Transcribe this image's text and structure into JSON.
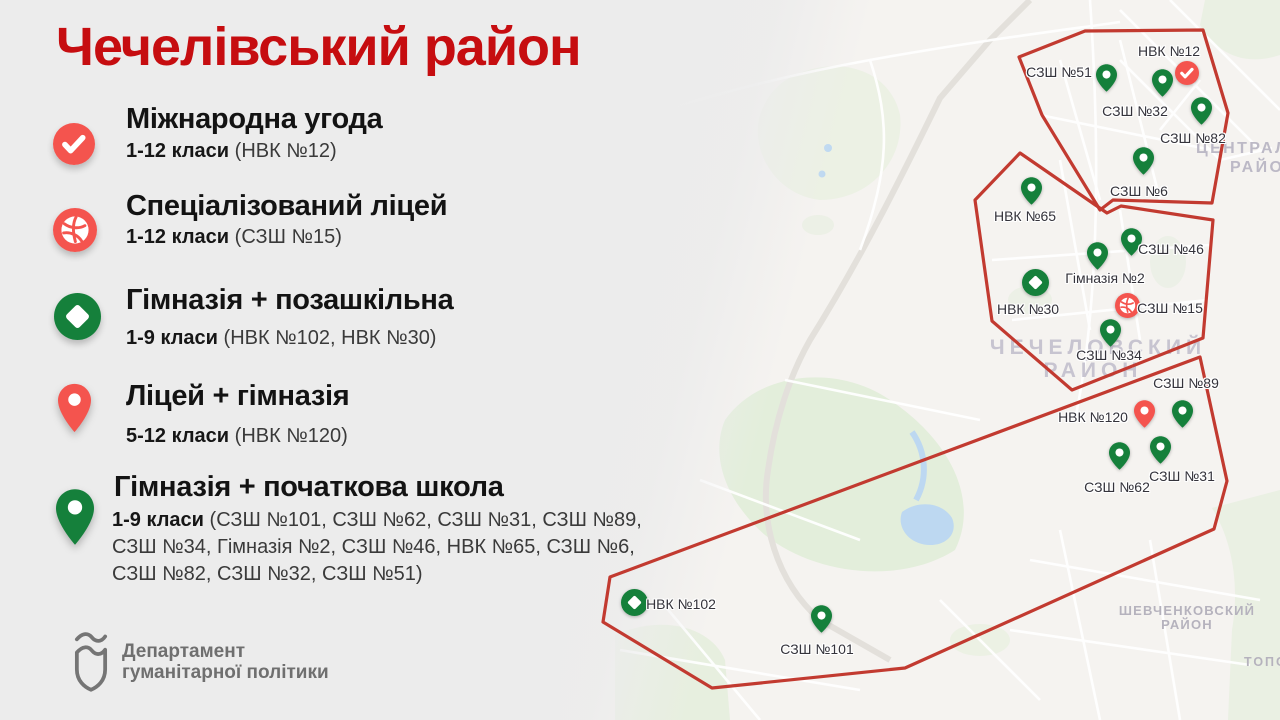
{
  "page": {
    "title": "Чечелівський район"
  },
  "colors": {
    "title_red": "#c60d10",
    "marker_red": "#f4544e",
    "marker_green": "#15803b",
    "region_outline_red": "#c23a30",
    "background_gray": "#ececec",
    "logo_gray": "#6f6f6f"
  },
  "legend": {
    "items": [
      {
        "icon": "check-circle",
        "title": "Міжнародна угода",
        "grades": "1-12 класи",
        "schools": "(НВК №12)"
      },
      {
        "icon": "ball-circle",
        "title": "Спеціалізований ліцей",
        "grades": "1-12 класи",
        "schools": "(СЗШ №15)"
      },
      {
        "icon": "diamond-circle",
        "title": "Гімназія + позашкільна",
        "grades": "1-9 класи",
        "schools": "(НВК №102, НВК №30)"
      },
      {
        "icon": "red-pin",
        "title": "Ліцей + гімназія",
        "grades": "5-12 класи",
        "schools": "(НВК №120)"
      },
      {
        "icon": "green-pin",
        "title": "Гімназія + початкова школа",
        "grades": "1-9 класи",
        "schools": "(СЗШ №101, СЗШ №62, СЗШ №31, СЗШ №89, СЗШ №34, Гімназія №2, СЗШ №46, НВК №65, СЗШ №6, СЗШ №82, СЗШ №32, СЗШ №51)"
      }
    ]
  },
  "footer": {
    "org_line1": "Департамент",
    "org_line2": "гуманітарної політики"
  },
  "map": {
    "district_labels": {
      "central_line1": "ЦЕНТРАЛ",
      "central_line2": "РАЙО",
      "chechelov_line1": "ЧЕЧЕЛОВСКИЙ",
      "chechelov_line2": "РАЙОН",
      "shevchenkov_line1": "ШЕВЧЕНКОВСКИЙ",
      "shevchenkov_line2": "РАЙОН",
      "topoli": "ТОПО"
    },
    "regions": [
      {
        "id": "north",
        "points": "525,31 643,30 668,113 652,203 553,200 540,210 482,115 459,57"
      },
      {
        "id": "central",
        "points": "460,153 547,213 561,206 653,220 643,338 512,390 432,321 415,200"
      },
      {
        "id": "south",
        "points": "640,357 667,481 654,529 345,668 152,688 43,622 50,577"
      }
    ],
    "markers": [
      {
        "type": "green-pin",
        "x": 546,
        "y": 92,
        "label": "СЗШ №51",
        "lx": 499,
        "ly": 72
      },
      {
        "type": "check-circle",
        "x": 627,
        "y": 73,
        "label": "НВК №12",
        "lx": 609,
        "ly": 51
      },
      {
        "type": "green-pin",
        "x": 602,
        "y": 97,
        "label": "СЗШ №32",
        "lx": 575,
        "ly": 111
      },
      {
        "type": "green-pin",
        "x": 641,
        "y": 125,
        "label": "СЗШ №82",
        "lx": 633,
        "ly": 138
      },
      {
        "type": "green-pin",
        "x": 583,
        "y": 175,
        "label": "СЗШ №6",
        "lx": 579,
        "ly": 191
      },
      {
        "type": "green-pin",
        "x": 471,
        "y": 205,
        "label": "НВК №65",
        "lx": 465,
        "ly": 216
      },
      {
        "type": "green-pin",
        "x": 571,
        "y": 256,
        "label": "СЗШ №46",
        "lx": 611,
        "ly": 249
      },
      {
        "type": "green-pin",
        "x": 537,
        "y": 270,
        "label": "Гімназія №2",
        "lx": 545,
        "ly": 278
      },
      {
        "type": "diamond-circle",
        "x": 475,
        "y": 282,
        "label": "НВК №30",
        "lx": 468,
        "ly": 309
      },
      {
        "type": "ball-circle",
        "x": 567,
        "y": 305,
        "label": "СЗШ №15",
        "lx": 610,
        "ly": 308
      },
      {
        "type": "green-pin",
        "x": 550,
        "y": 347,
        "label": "СЗШ №34",
        "lx": 549,
        "ly": 355
      },
      {
        "type": "green-pin",
        "x": 622,
        "y": 428,
        "label": "СЗШ №89",
        "lx": 626,
        "ly": 383
      },
      {
        "type": "red-pin",
        "x": 584,
        "y": 428,
        "label": "НВК №120",
        "lx": 533,
        "ly": 417
      },
      {
        "type": "green-pin",
        "x": 600,
        "y": 464,
        "label": "СЗШ №31",
        "lx": 622,
        "ly": 476
      },
      {
        "type": "green-pin",
        "x": 559,
        "y": 470,
        "label": "СЗШ №62",
        "lx": 557,
        "ly": 487
      },
      {
        "type": "diamond-circle",
        "x": 74,
        "y": 602,
        "label": "НВК №102",
        "lx": 121,
        "ly": 604
      },
      {
        "type": "green-pin",
        "x": 261,
        "y": 633,
        "label": "СЗШ №101",
        "lx": 257,
        "ly": 649
      }
    ]
  }
}
